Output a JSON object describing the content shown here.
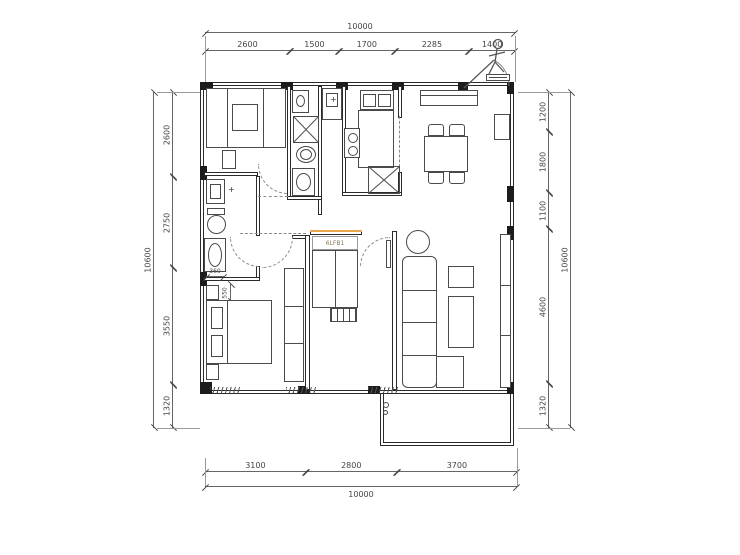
{
  "drawing": {
    "type": "apartment-floor-plan",
    "units": "mm"
  },
  "dims": {
    "top": {
      "total": "10000",
      "segments": [
        "2600",
        "1500",
        "1700",
        "2285",
        "1400"
      ]
    },
    "bottom": {
      "total": "10000",
      "segments": [
        "3100",
        "2800",
        "3700"
      ]
    },
    "left": {
      "total": "10600",
      "segments": [
        "2600",
        "2750",
        "3550",
        "1320"
      ]
    },
    "right": {
      "total": "10600",
      "segments": [
        "1200",
        "1800",
        "1100",
        "4600",
        "1320"
      ]
    },
    "interior": {
      "bed1_offset": "550",
      "bath2_offset": "360"
    }
  },
  "labels": {
    "bed2_headboard": "6LFB1"
  },
  "icons": {
    "faucet": "+"
  },
  "colors": {
    "line": "#4a4a4a",
    "wall": "#1c1c1c",
    "dim_text": "#444444",
    "highlight": "#eba74b"
  }
}
